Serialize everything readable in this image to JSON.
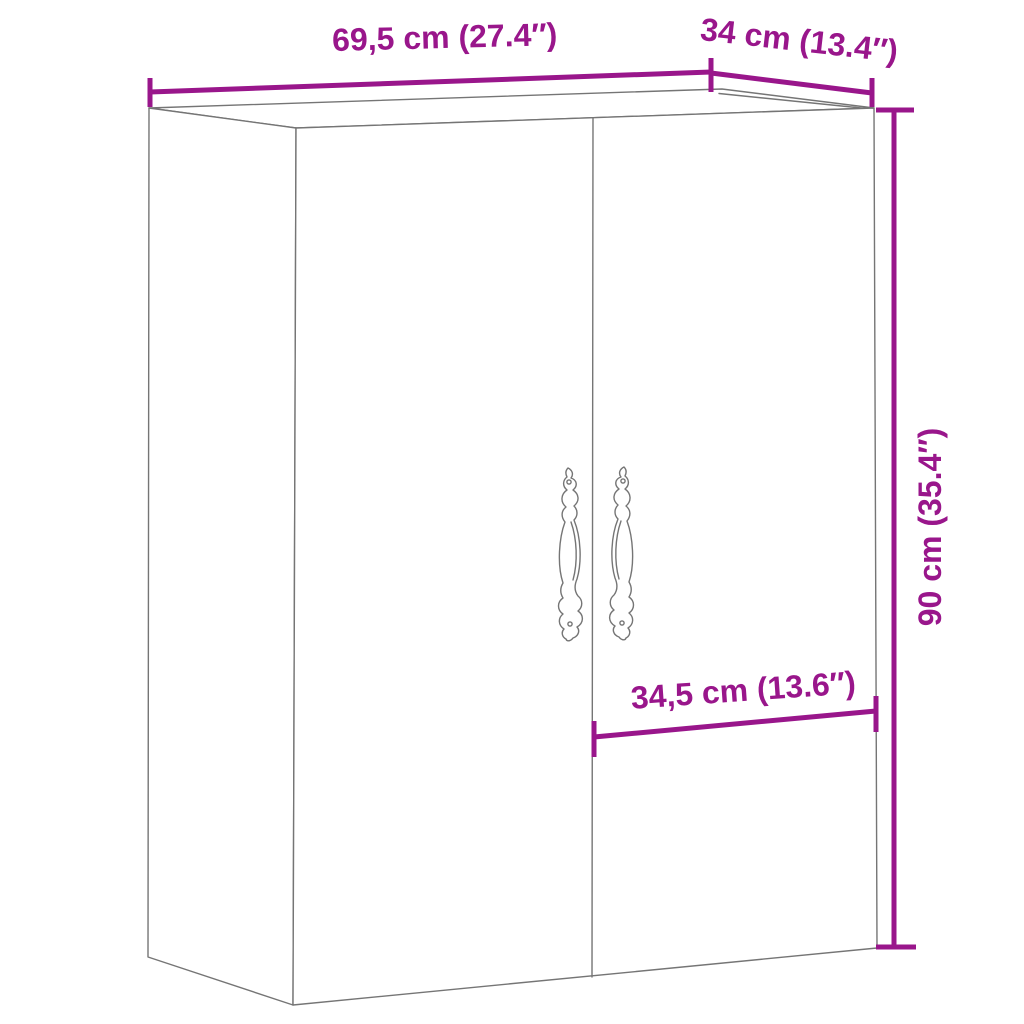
{
  "figure": {
    "type": "product-dimension-diagram",
    "subject": "two-door wall cabinet with ornate pull handles"
  },
  "colors": {
    "dimension_accent": "#99168B",
    "drawing_outline": "#757575",
    "background": "#FFFFFF"
  },
  "labels": {
    "width": "69,5 cm (27.4″)",
    "depth": "34 cm (13.4″)",
    "height": "90 cm (35.4″)",
    "door_width": "34,5 cm (13.6″)"
  },
  "values": {
    "width_cm": "69,5",
    "width_inch": "27.4",
    "depth_cm": "34",
    "depth_inch": "13.4",
    "height_cm": "90",
    "height_inch": "35.4",
    "door_width_cm": "34,5",
    "door_width_inch": "13.6"
  }
}
